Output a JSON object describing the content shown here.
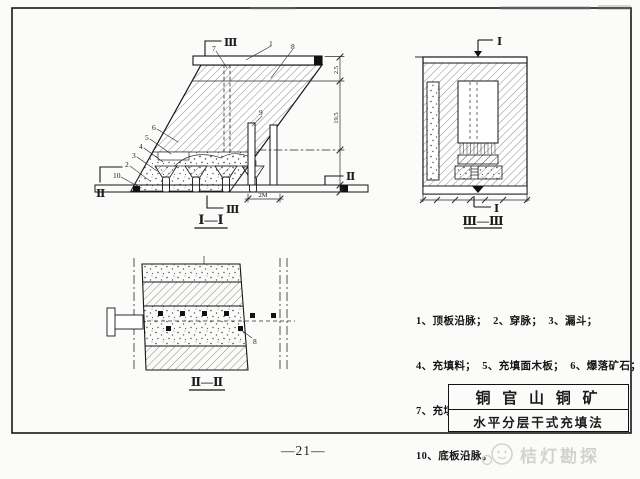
{
  "page": {
    "number": "—21—",
    "watermark": "桔灯勘探"
  },
  "title_block": {
    "mine": "铜 官 山 铜 矿",
    "method": "水平分层干式充填法"
  },
  "legend": {
    "line1": "1、顶板沿脉；  2、穿脉；  3、漏斗；",
    "line2": "4、充填料；  5、充填面木板；  6、爆落矿石；",
    "line3": "7、充填井；  8、顶柱；  9、人行天井；",
    "line4": "10、底板沿脉。"
  },
  "sections": {
    "s1_title": "Ⅰ—Ⅰ",
    "s2_title": "Ⅱ—Ⅱ",
    "s3_title": "Ⅲ—Ⅲ"
  },
  "marks": {
    "m1": "Ⅰ",
    "m2": "Ⅱ",
    "m3": "Ⅲ"
  },
  "callouts": {
    "n1": "1",
    "n2": "2",
    "n3": "3",
    "n4": "4",
    "n5": "5",
    "n6": "6",
    "n7": "7",
    "n8": "8",
    "n9": "9",
    "n10": "10"
  },
  "dimensions": {
    "d_top": "2.5",
    "d_mid": "19.5",
    "d_raise": "2M"
  }
}
